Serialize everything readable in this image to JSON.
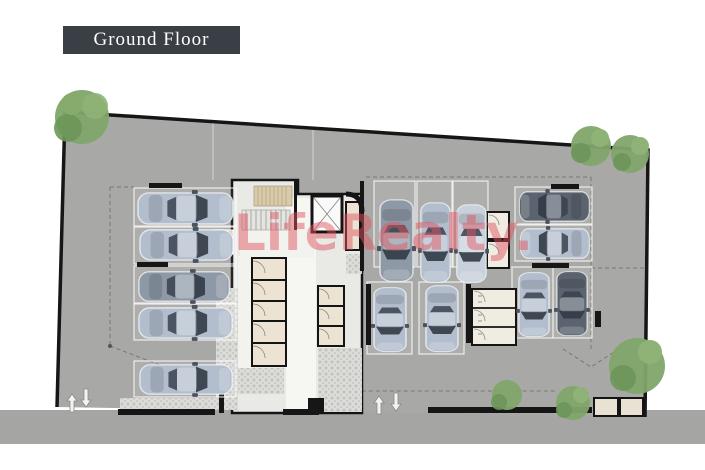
{
  "title_block": {
    "label": "Ground Floor",
    "bg": "#3a3e45",
    "text_color": "#ffffff"
  },
  "watermark": {
    "text": "LifeRealty.",
    "color": "#e0545f"
  },
  "plan": {
    "type": "architectural-site-plan",
    "floor": "Ground Floor",
    "site_color": "#a8a9a6",
    "road_color": "#a5a6a3",
    "building_floor_color": "#e9e9e6",
    "room_color": "#ece3d3",
    "cobble_color": "#dcdcd9",
    "tree_color": "#7fa569",
    "parking": {
      "total_cars": 14,
      "groups": [
        {
          "name": "left-row",
          "cars": 5,
          "orientation": "horizontal"
        },
        {
          "name": "middle-top-row",
          "cars": 3,
          "orientation": "vertical"
        },
        {
          "name": "middle-bottom-row",
          "cars": 2,
          "orientation": "vertical"
        },
        {
          "name": "right-top-row",
          "cars": 2,
          "orientation": "horizontal"
        },
        {
          "name": "right-bottom-pair",
          "cars": 2,
          "orientation": "vertical"
        }
      ]
    },
    "trees": 6,
    "driveways": [
      {
        "location": "bottom-left",
        "arrows": [
          "in",
          "out"
        ]
      },
      {
        "location": "bottom-center",
        "arrows": [
          "in",
          "out"
        ]
      }
    ],
    "core_elements": [
      "stairs",
      "elevator",
      "storage-rooms",
      "corridor"
    ]
  }
}
